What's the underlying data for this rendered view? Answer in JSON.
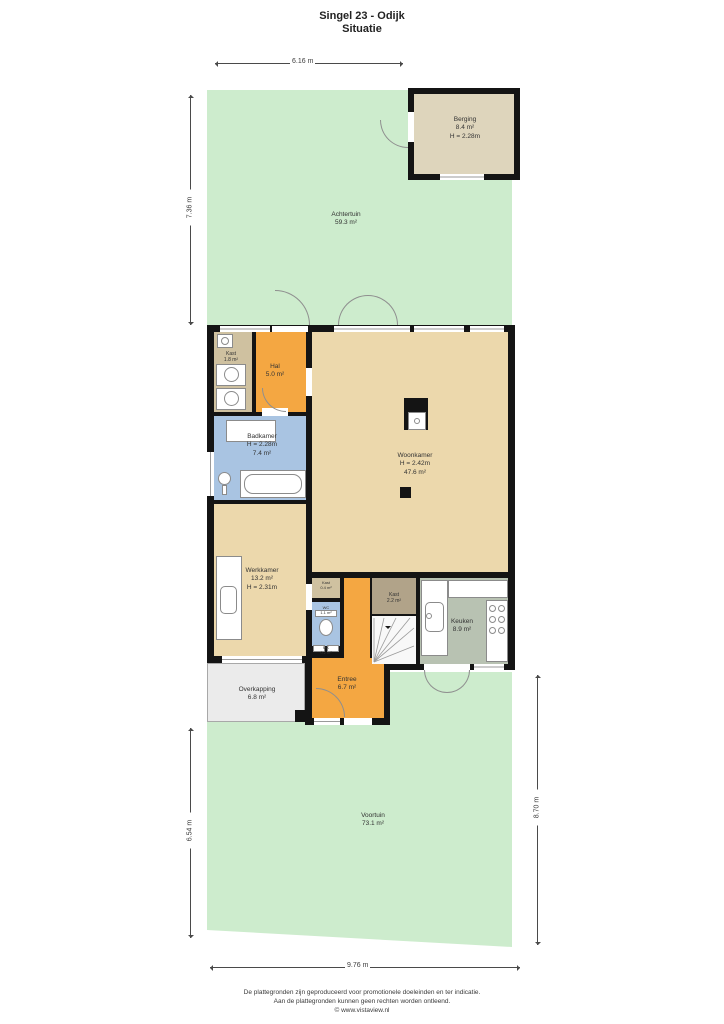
{
  "title": {
    "line1": "Singel 23 - Odijk",
    "line2": "Situatie"
  },
  "dimensions": {
    "top": "6.16 m",
    "left_upper": "7.36 m",
    "left_lower": "6.54 m",
    "right": "8.70 m",
    "bottom": "9.76 m"
  },
  "outdoor": {
    "achtertuin": {
      "name": "Achtertuin",
      "area": "59.3 m²"
    },
    "voortuin": {
      "name": "Voortuin",
      "area": "73.1 m²"
    },
    "overkapping": {
      "name": "Overkapping",
      "area": "6.8 m²"
    }
  },
  "rooms": {
    "berging": {
      "name": "Berging",
      "area": "8.4 m²",
      "height": "H = 2.28m"
    },
    "kast_bij_hal": {
      "name": "Kast",
      "area": "1.8 m²"
    },
    "hal": {
      "name": "Hal",
      "area": "5.0 m²"
    },
    "badkamer": {
      "name": "Badkamer",
      "height": "H = 2.28m",
      "area": "7.4 m²"
    },
    "woonkamer": {
      "name": "Woonkamer",
      "height": "H = 2.42m",
      "area": "47.6 m²"
    },
    "werkkamer": {
      "name": "Werkkamer",
      "area": "13.2 m²",
      "height": "H = 2.31m"
    },
    "kast_klein": {
      "name": "Kast",
      "area": "0.4 m²"
    },
    "wc": {
      "name": "WC",
      "area": "1.1 m²"
    },
    "kast_trap": {
      "name": "Kast",
      "area": "2.2 m²"
    },
    "keuken": {
      "name": "Keuken",
      "area": "8.9 m²"
    },
    "entree": {
      "name": "Entree",
      "area": "6.7 m²"
    },
    "meterkast": {
      "name": "MK",
      "area": "0.2 m²"
    }
  },
  "footer": {
    "line1": "De plattegronden zijn geproduceerd voor promotionele doeleinden en ter indicatie.",
    "line2": "Aan de plattegronden kunnen geen rechten worden ontleend.",
    "line3": "© www.vistaview.nl"
  },
  "colors": {
    "wall": "#141414",
    "garden_green": "#cdeccd",
    "floor_tan": "#ecd8ac",
    "floor_orange": "#f4a742",
    "floor_blue": "#a9c4e2",
    "floor_keuken_green": "#b8c2b2",
    "floor_kast_tan": "#cfc1a0",
    "floor_kast_dark": "#b1a389",
    "floor_berging": "#ded5bc",
    "overkapping_grey": "#ebebeb",
    "stairs_white": "#f8f8f8"
  }
}
